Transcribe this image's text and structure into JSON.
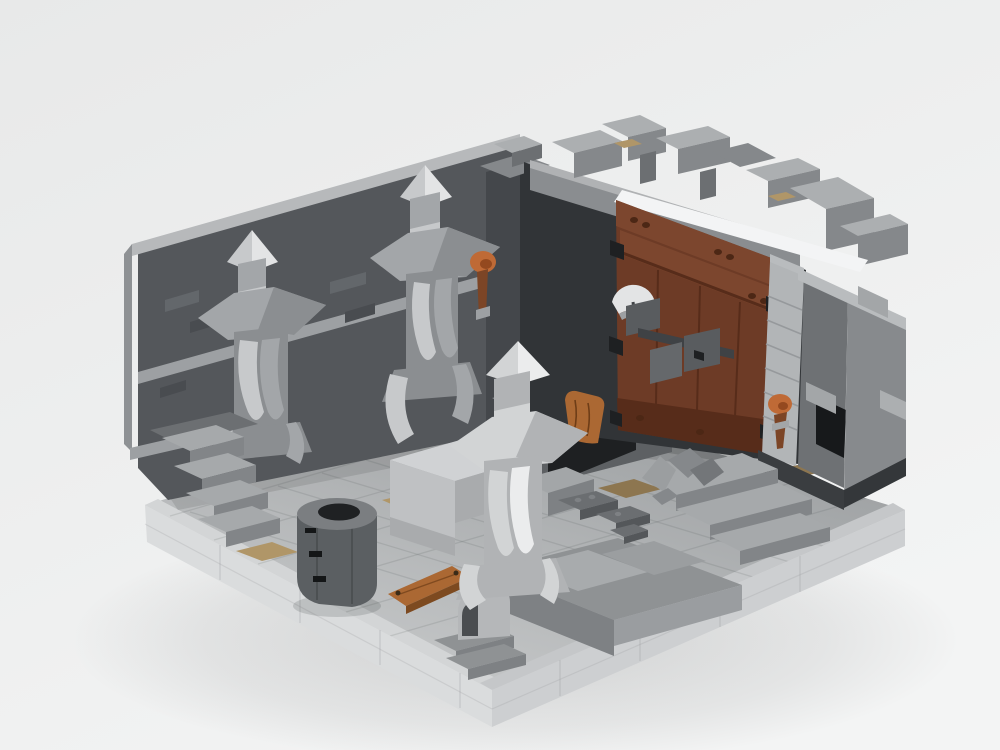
{
  "scene": {
    "kind": "3d-render",
    "subject": "LEGO brick model of a ruined castle dungeon interior",
    "labels": {
      "background": "studio backdrop",
      "base": "light gray baseplate",
      "floor": "stone tile floor",
      "left_wall": "dark stone wall with brick relief",
      "left_stairs": "stone staircase",
      "corner_tower": "corner wall pillar",
      "fireplace": "arched hearth opening",
      "gate_wall": "ruined gate wall",
      "crenellations": "broken battlement blocks",
      "door": "brown wooden gate",
      "axe": "axe blade on gate",
      "jamb": "stone door jamb",
      "right_wall": "gray wall tower",
      "niche": "dark wall niche",
      "pillar_left": "carved stone pillar with spire",
      "pillar_middle": "carved stone pillar with spire",
      "pillar_front": "carved stone pillar with spire",
      "torch_corner": "wall torch",
      "torch_right": "wall torch",
      "well": "round stone well",
      "altar": "stone table block",
      "plank": "wooden plank",
      "shield": "wooden shield",
      "plates": "scattered gray bricks",
      "rubble": "rubble pile",
      "right_stairs": "wide stone steps",
      "terrace": "raised stone platform",
      "front_arch": "curved arch stone",
      "tan_tiles": "tan floor tiles"
    }
  },
  "colors": {
    "bg_top": "#e8e9e9",
    "bg_bottom": "#f3f4f4",
    "black": "#1e2022",
    "floor_light": "#c6c8c9",
    "floor_dark": "#9da0a2",
    "grid_line": "#4a4c4e",
    "base_side_l": "#dadcdd",
    "base_side_r": "#cdcfd1",
    "base_edge_l": "#d3d5d6",
    "base_edge_r": "#c5c7c9",
    "seam": "#9a9c9e",
    "wall_dark": "#54575b",
    "wall_darker": "#44474b",
    "wall_darkest": "#313437",
    "brick_light": "#63676b",
    "brick_dark": "#494c50",
    "wall_cap": "#b7b9bb",
    "string": "#9da0a3",
    "outer_left": "#8e9194",
    "beam": "#8a8d90",
    "beam_cap": "#b0b2b4",
    "crenel": "#85888b",
    "crenel_light": "#acafb1",
    "crenel_dark": "#6c6f72",
    "white_trim": "#f3f4f5",
    "door": "#6d3b26",
    "door_dark": "#572c1a",
    "door_mid": "#7c462e",
    "stud": "#4c2715",
    "iron": "#3f4245",
    "iron_mid": "#595c5f",
    "iron_light": "#65686b",
    "jamb": "#b2b5b7",
    "jamb_line": "#96999c",
    "rw_inner": "#6e7174",
    "rw_outer": "#878a8d",
    "rw_cap": "#b9bcbe",
    "rw_trim": "#a3a6a8",
    "niche": "#17191b",
    "base_band": "#3a3d40",
    "base_band2": "#34373a",
    "p_body": "#8b8e91",
    "p_mid": "#a3a6a9",
    "p_light": "#c7c9cb",
    "p_lightest": "#e3e4e5",
    "p_dark": "#747779",
    "f_body": "#b1b3b5",
    "f_light": "#d2d4d5",
    "f_lightest": "#ebeced",
    "well_body": "#5b5f62",
    "well_rim": "#7b7e81",
    "well_hole": "#1f2123",
    "vent": "#141617",
    "altar_top": "#d0d2d4",
    "altar_left": "#bfc1c3",
    "altar_front": "#a9abad",
    "step_top": "#a6a9ab",
    "step_riser": "#828588",
    "terrace": "#8f9294",
    "terrace_slab": "#a8abad",
    "terrace_face": "#7e8184",
    "terrace_right": "#9a9da0",
    "wood": "#ab6833",
    "wood_dark": "#7d4a20",
    "grain": "#6e3d17",
    "nail": "#3b2b18",
    "flame": "#bf6a36",
    "flame_core": "#94491f",
    "torch": "#7c4526",
    "tan": "#b09668",
    "tan_dark": "#8d7650",
    "plate": "#6b6e71",
    "plate_side": "#54575a",
    "plate_stud": "#7e8184",
    "rubble_l": "#9b9ea0",
    "rubble_m": "#85888b",
    "rubble_d": "#737679",
    "arch_light": "#b5b7b9",
    "arch_dark": "#4a4d50",
    "fp_face": "#5d6063",
    "fp_lintel": "#8a8d90"
  }
}
